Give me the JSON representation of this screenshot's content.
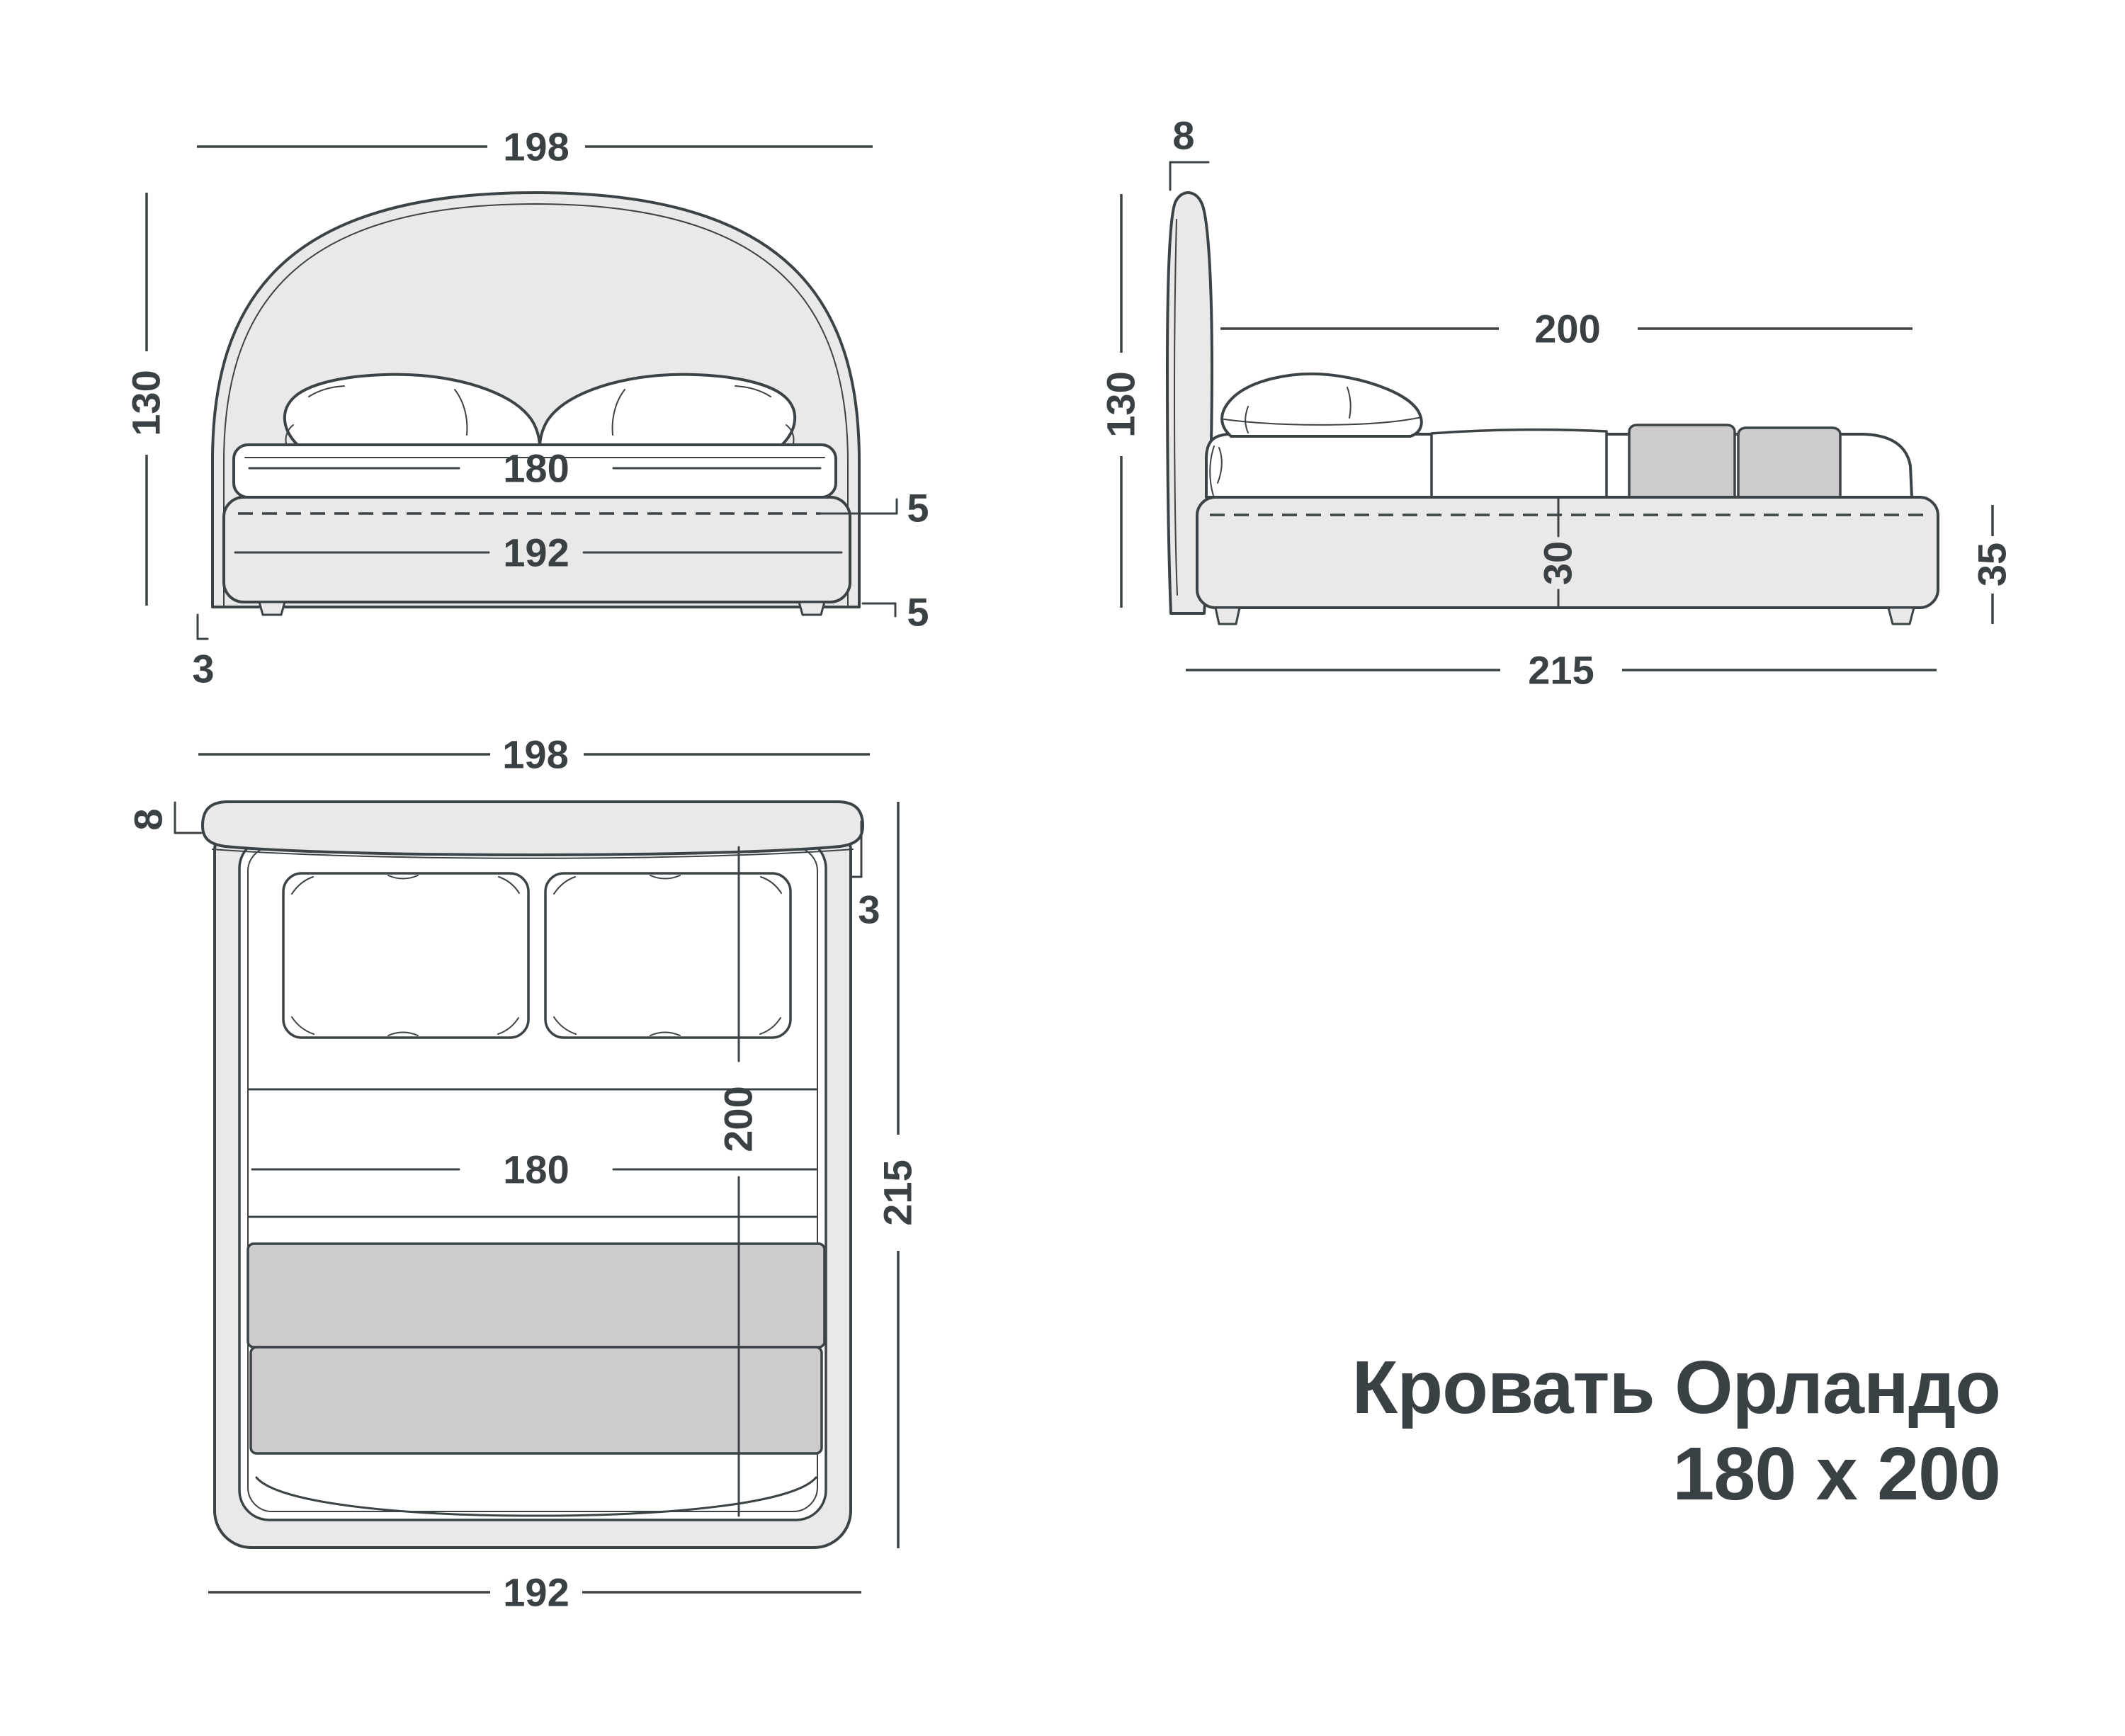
{
  "title": {
    "line1": "Кровать Орландо",
    "line2": "180 x 200"
  },
  "views": {
    "front": {
      "label": "front-view",
      "dims": {
        "overall_width": "198",
        "overall_height": "130",
        "mattress_width": "180",
        "base_width": "192",
        "mattress_overlap": "5",
        "leg_height": "5",
        "headboard_floor_gap": "3"
      }
    },
    "side": {
      "label": "side-view",
      "dims": {
        "headboard_thickness": "8",
        "overall_height": "130",
        "sleeping_length": "200",
        "base_height": "30",
        "base_with_legs_height": "35",
        "overall_length": "215"
      }
    },
    "top": {
      "label": "top-view",
      "dims": {
        "overall_width": "198",
        "headboard_thickness": "8",
        "headboard_offset": "3",
        "sleeping_length": "200",
        "overall_length": "215",
        "mattress_width": "180",
        "base_width": "192"
      }
    }
  },
  "colors": {
    "line": "#3c4347",
    "ink": "#3a4145",
    "panel": "#e9e9e9",
    "blanket": "#cdcbcc",
    "page_bg": "#ffffff"
  }
}
